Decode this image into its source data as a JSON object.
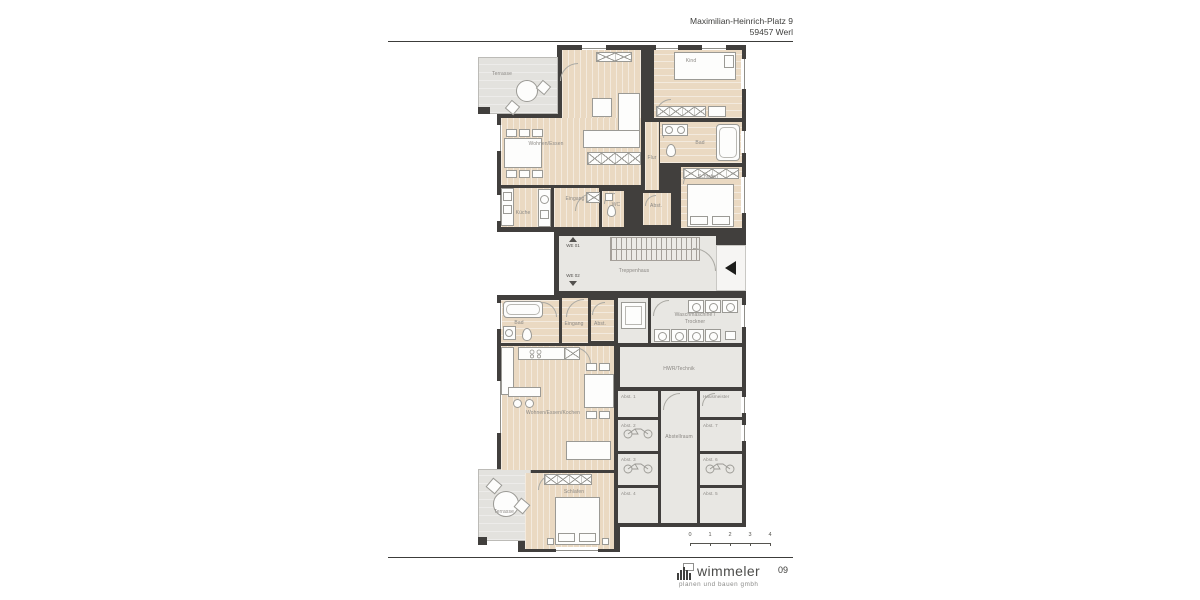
{
  "document": {
    "address_line1": "Maximilian-Heinrich-Platz 9",
    "address_line2": "59457 Werl",
    "page_number": "09"
  },
  "footer": {
    "logo_name": "wimmeler",
    "logo_tagline": "planen und bauen gmbh"
  },
  "scale_bar": {
    "ticks": [
      "0",
      "1",
      "2",
      "3",
      "4"
    ]
  },
  "plan": {
    "upper": {
      "terrasse": "Terrasse",
      "wohnen": "Wohnen/Essen",
      "kind": "Kind",
      "bad": "Bad",
      "schlafen": "Schlafen",
      "flur": "Flur",
      "kueche": "Küche",
      "eingang": "Eingang",
      "wc": "WC",
      "abst": "Abst."
    },
    "stair": {
      "treppenhaus": "Treppenhaus",
      "we01": "WE 01",
      "we02": "WE 02"
    },
    "lower": {
      "bad": "Bad",
      "eingang": "Eingang",
      "abst": "Abst.",
      "wohnen": "Wohnen/Essen/Kochen",
      "schlafen": "Schlafen",
      "terrasse": "Terrasse"
    },
    "utility": {
      "wasch1": "Waschmaschine /",
      "wasch2": "Trockner",
      "hwr": "HWR/Technik",
      "abstellraum": "Abstellraum",
      "hausmeister": "Hausmeister",
      "abst1": "Abst. 1",
      "abst2": "Abst. 2",
      "abst3": "Abst. 3",
      "abst4": "Abst. 4",
      "abst5": "Abst. 5",
      "abst6": "Abst. 6",
      "abst7": "Abst. 7"
    }
  },
  "icons": {
    "entrance_arrow": "left-triangle",
    "we01_arrow": "up-triangle",
    "we02_arrow": "down-triangle",
    "logo_mark": "building-bars",
    "bicycle": "bicycle",
    "washing_machine": "square-with-drum-circle"
  },
  "colors": {
    "wall": "#413f3d",
    "wood_floor": "#ead9c2",
    "hard_floor": "#e8e7e3",
    "terrace_floor": "#e3e2de",
    "furniture_stroke": "#9b9a95",
    "label_text": "#8b8884",
    "entrance_marker": "#1d1d1b"
  }
}
